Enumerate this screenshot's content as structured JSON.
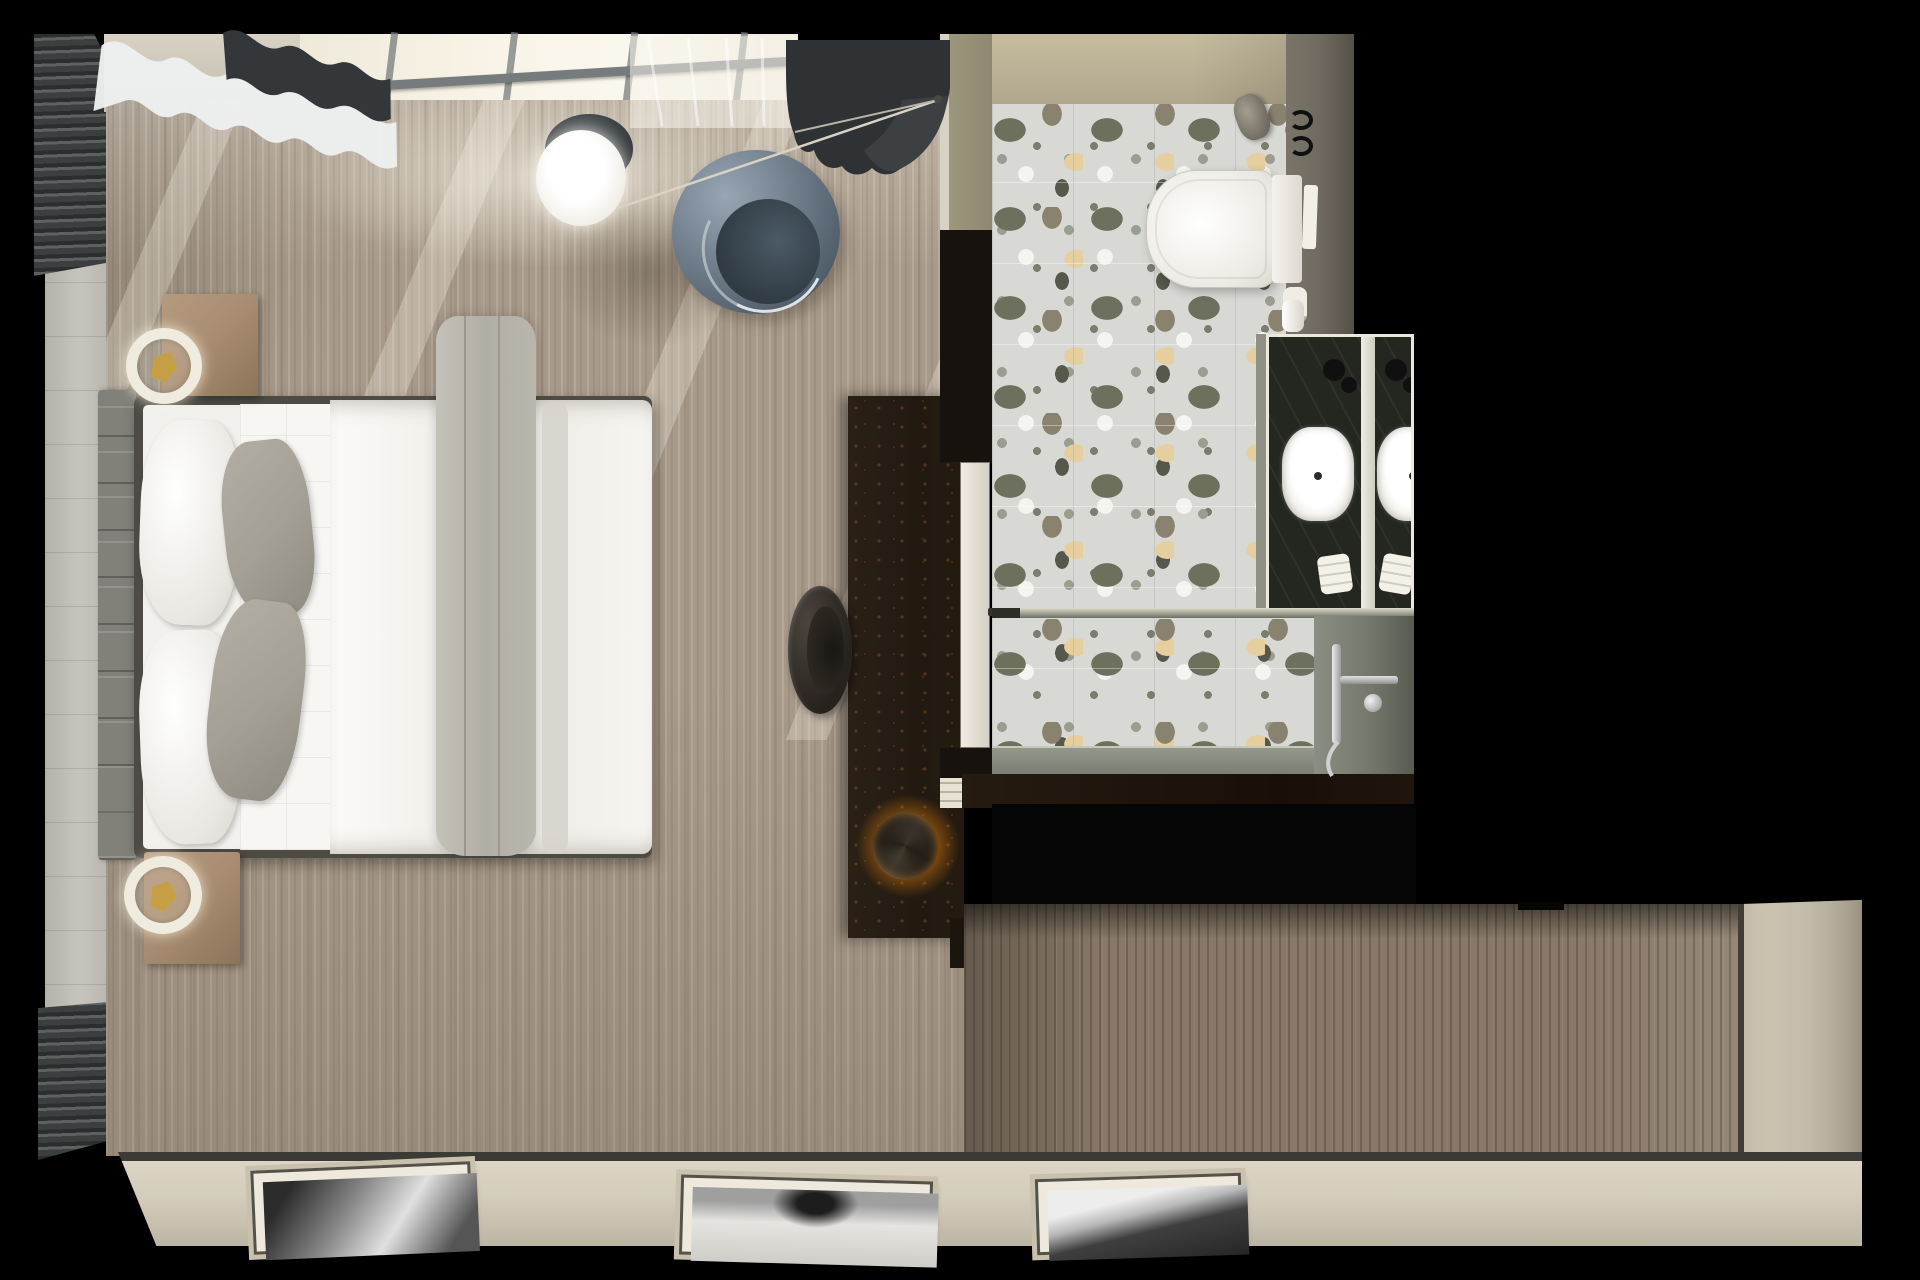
{
  "scene": {
    "label": "Top-down 3D render of a hotel bedroom suite with ensuite bathroom and entry hallway",
    "view": "top-down floor-plan render",
    "visible_text": "none"
  },
  "colors": {
    "bg": "#000000",
    "carpet": "#a89a8a",
    "wood": "#877867",
    "stone": "#c7c4bd",
    "slat-dark": "#2b2e2e",
    "wall-beige": "#d8d2c4",
    "wall-olive": "#9d977e",
    "bath-wall": "#ded8c7",
    "terrazzo": "#d8d9d5",
    "chip-olive": "#6d705d",
    "chip-tan": "#e6cf9f",
    "chip-dark": "#55584a",
    "chip-white": "#f4f4f1",
    "chip-gray": "#9a9d90",
    "wall-right": "#6f6a5f",
    "marble": "#232720",
    "divider-white": "#ece9dc",
    "glass": "#f8f4e7",
    "frame-gray": "#767c7e",
    "curtain-white": "#edeff0",
    "curtain-dark": "#303437",
    "chair": "#64737f",
    "chair-deep": "#303b44",
    "console": "#221a11",
    "glow": "#f29a0d",
    "stool": "#26221d",
    "bedframe": "#4e4b45",
    "blanket": "#b1aea5",
    "pillow-gray": "#a39f94",
    "headboard": "#818079",
    "wood-night": "#a98e72",
    "gold": "#c69f44",
    "strip": "#d3ccbb",
    "door-beige": "#cfc7b3",
    "line-dark": "#3b3a35",
    "shower-wall": "#75786c",
    "curb": "#949889"
  },
  "bedroom": {
    "carpet": {
      "label": "Beige striated carpet with sunbeams"
    },
    "window": {
      "label": "Bright window band with gray mullions"
    },
    "curtains": {
      "white": "White wavy curtain",
      "dark": "Charcoal wavy curtain",
      "sheer": "Sheer translucent curtain"
    },
    "slat_wall": {
      "label": "Dark louvred slat wall panel"
    },
    "stone_wall": {
      "label": "Light stone tiled wall"
    },
    "bed": {
      "label": "Double bed with white duvet and draped grey throw",
      "headboard": "Grey tufted headboard",
      "pillows": [
        {
          "label": "White pillow"
        },
        {
          "label": "White pillow"
        },
        {
          "label": "Grey accent pillow"
        },
        {
          "label": "Grey accent pillow"
        }
      ],
      "blanket": "Grey throw blanket",
      "quilt": "Quilted white runner"
    },
    "nightstands": [
      {
        "label": "Wooden nightstand",
        "lamp": "White ring lamp with brass ornament"
      },
      {
        "label": "Wooden nightstand",
        "lamp": "White ring lamp with brass ornament"
      }
    ],
    "chair": {
      "label": "Blue-grey swivel lounge chair"
    },
    "side_table": {
      "label": "Round dark side table"
    },
    "pendant": {
      "label": "White globe pendant lamp"
    },
    "floor_lamp": {
      "label": "Arc floor lamp with thin metal rod"
    },
    "console": {
      "label": "Dark media console",
      "lamp": "Sculptural lamp with warm orange glow"
    },
    "stool": {
      "label": "Charcoal round stool"
    },
    "door": {
      "label": "Bathroom door with handle"
    }
  },
  "bathroom": {
    "floor": {
      "label": "Grey terrazzo tile floor"
    },
    "toilet": {
      "label": "Wall-hung white toilet with cistern"
    },
    "flush_plate": "White flush plate",
    "cistern_knob": "Grey wall knob",
    "towel_hooks": "Black wall hooks",
    "brush": "Toilet brush cup",
    "vanity": {
      "label": "Double vanity in dark green marble",
      "sinks": [
        {
          "label": "White vessel sink"
        },
        {
          "label": "White vessel sink"
        }
      ],
      "faucets": "Black round faucets",
      "towels": "Rolled white towels",
      "divider": "White partition between sinks"
    },
    "shower": {
      "label": "Walk-in shower",
      "glass": "Glass partition rail",
      "fixture": "Chrome shower mixer with hand shower",
      "curb": "Grey stone shower floor"
    }
  },
  "hallway": {
    "floor": {
      "label": "Wood plank hallway floor"
    },
    "void": {
      "label": "Dark wardrobe recess"
    },
    "door": {
      "label": "Beige entry door wall"
    },
    "artworks": [
      {
        "label": "Black and white framed artwork leaning on wall"
      },
      {
        "label": "Black and white framed artwork leaning on wall"
      },
      {
        "label": "Black and white framed artwork leaning on wall"
      }
    ]
  }
}
